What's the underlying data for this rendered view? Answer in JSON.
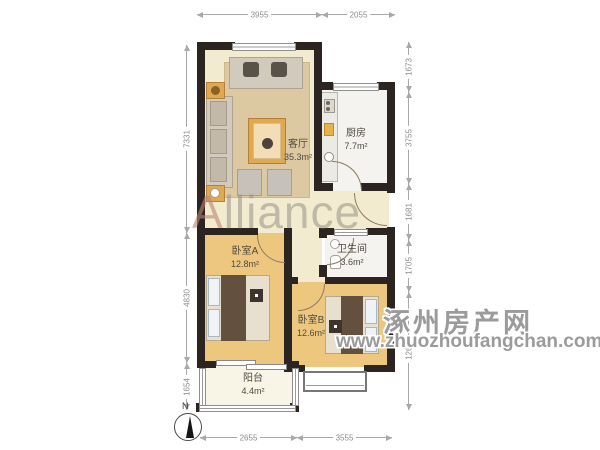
{
  "watermark": {
    "brand": "Alliance",
    "site_name": "涿州房产网",
    "site_url": "www.zhuozhoufangchan.com"
  },
  "compass": {
    "north_label": "N"
  },
  "rooms": [
    {
      "id": "living-room",
      "name": "客厅",
      "area": "35.3m²"
    },
    {
      "id": "kitchen",
      "name": "厨房",
      "area": "7.7m²"
    },
    {
      "id": "bedroom-a",
      "name": "卧室A",
      "area": "12.8m²"
    },
    {
      "id": "bathroom",
      "name": "卫生间",
      "area": "3.6m²"
    },
    {
      "id": "bedroom-b",
      "name": "卧室B",
      "area": "12.6m²"
    },
    {
      "id": "balcony",
      "name": "阳台",
      "area": "4.4m²"
    }
  ],
  "dimensions_mm": {
    "top": [
      "3955",
      "2055"
    ],
    "bottom": [
      "2655",
      "3555"
    ],
    "left": [
      "7331",
      "4830",
      "1654"
    ],
    "right": [
      "1673",
      "3755",
      "1681",
      "1705",
      "1265"
    ]
  },
  "colors": {
    "wall": "#2b2420",
    "living_floor": "#f3ebcf",
    "wood_floor": "#eec77e",
    "tile_floor": "#f4f3ef",
    "balcony_floor": "#f8f5e6",
    "rug": "#ddc9a1",
    "accent_wood": "#e0a94f",
    "dim_line": "#a8a8a8",
    "watermark_gray": "#9b9b9b"
  }
}
